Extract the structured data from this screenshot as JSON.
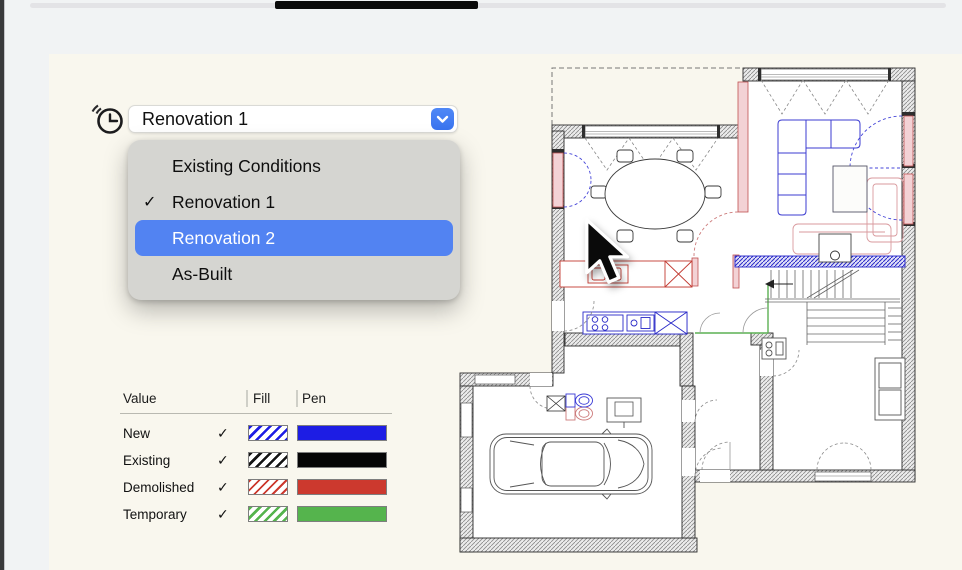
{
  "revision_selector": {
    "value": "Renovation 1",
    "icon": "clock-history",
    "menu": {
      "check_glyph": "✓",
      "items": [
        {
          "label": "Existing Conditions",
          "checked": false,
          "highlighted": false
        },
        {
          "label": "Renovation 1",
          "checked": true,
          "highlighted": false
        },
        {
          "label": "Renovation 2",
          "checked": false,
          "highlighted": true
        },
        {
          "label": "As-Built",
          "checked": false,
          "highlighted": false
        }
      ]
    },
    "highlight_color": "#5283f2",
    "button_color": "#3f7bf4"
  },
  "legend": {
    "columns": [
      "Value",
      "Fill",
      "Pen"
    ],
    "check_glyph": "✓",
    "rows": [
      {
        "value": "New",
        "checked": true,
        "color": "#1d1de4"
      },
      {
        "value": "Existing",
        "checked": true,
        "color": "#050505"
      },
      {
        "value": "Demolished",
        "checked": true,
        "color": "#cc392e"
      },
      {
        "value": "Temporary",
        "checked": true,
        "color": "#55b44d"
      }
    ]
  },
  "floor_plan": {
    "renovation_colors": {
      "new": "#2a2ac8",
      "existing": "#2b2b2b",
      "demolished": "#c23b32",
      "temporary": "#5cb154"
    }
  },
  "canvas_colors": {
    "paper": "#f9f7ee",
    "app_background": "#f1f3f4"
  }
}
